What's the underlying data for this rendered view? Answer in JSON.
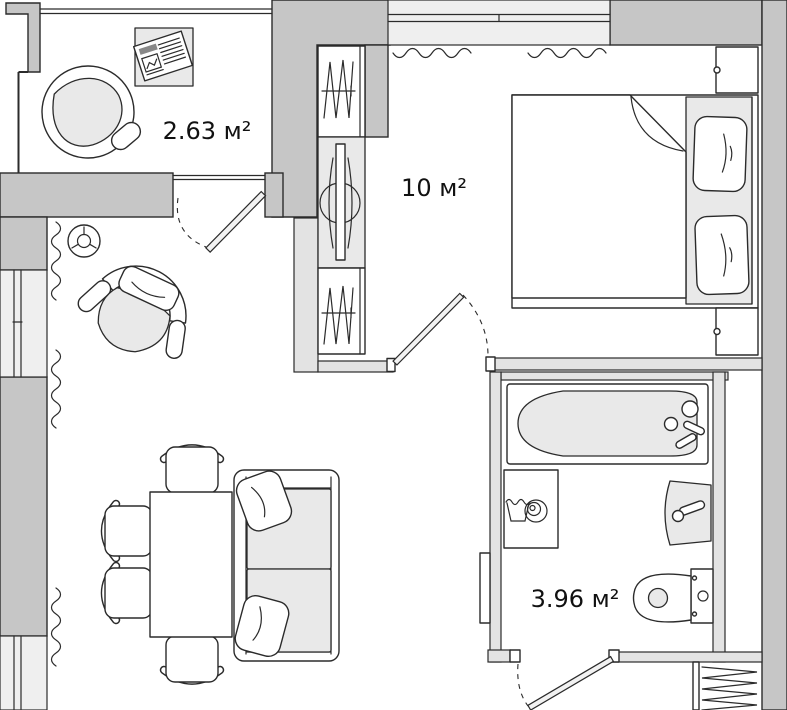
{
  "title": "Apartment floor plan",
  "rooms": {
    "balcony": {
      "area_label": "2.63 м²",
      "furniture": [
        "hanging-chair",
        "footrest",
        "side-table",
        "newspaper"
      ]
    },
    "bedroom": {
      "area_label": "10 м²",
      "furniture": [
        "wardrobe",
        "dresser-with-mirror",
        "wardrobe",
        "double-bed",
        "pillow",
        "pillow",
        "nightstand",
        "nightstand",
        "radiator",
        "radiator"
      ]
    },
    "bathroom": {
      "area_label": "3.96 м²",
      "furniture": [
        "bathtub",
        "washing-machine",
        "washbasin",
        "toilet"
      ]
    },
    "living_room": {
      "furniture": [
        "ventilation-symbol",
        "armchair",
        "dining-table",
        "chair",
        "chair",
        "chair",
        "chair",
        "sofa",
        "sofa-pillow",
        "sofa-pillow",
        "radiator",
        "radiator",
        "radiator"
      ]
    },
    "hallway": {
      "furniture": [
        "built-in-closet",
        "open-door-leaf"
      ]
    }
  },
  "doors": [
    "balcony-door",
    "bedroom-door",
    "bathroom-door"
  ],
  "windows": [
    "balcony-glazing",
    "bedroom-window",
    "living-room-window-upper",
    "living-room-window-lower"
  ],
  "colors": {
    "wall_thick": "#c6c6c6",
    "wall_light": "#e3e3e3",
    "window_fill": "#efefef",
    "cushion": "#e9e9e9",
    "outline": "#2b2b2b",
    "floor": "#ffffff",
    "label": "#111111"
  }
}
